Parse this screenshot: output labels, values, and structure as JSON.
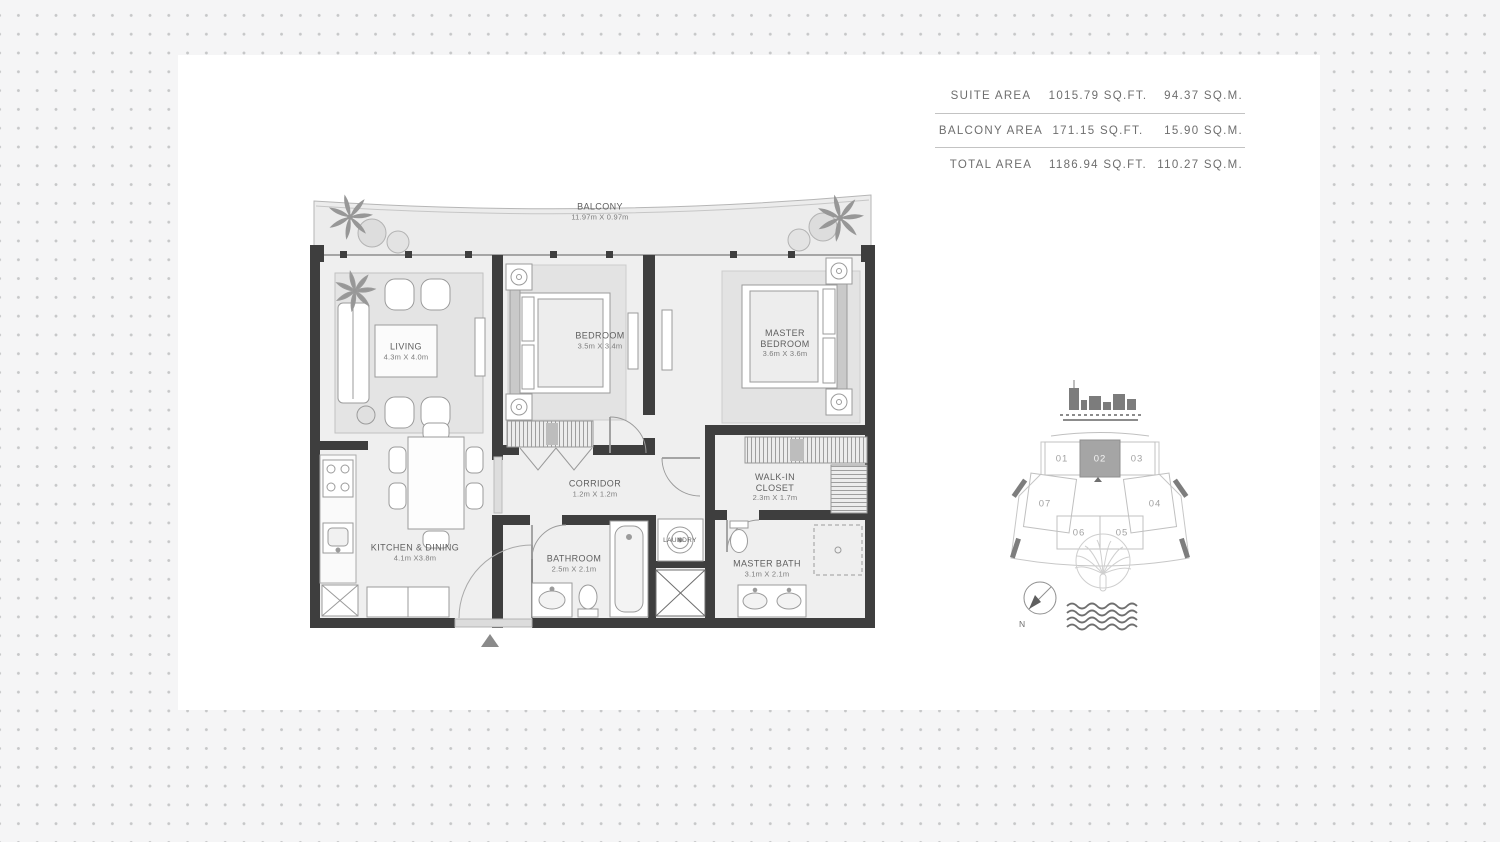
{
  "area_table": {
    "rows": [
      {
        "label": "SUITE AREA",
        "sqft": "1015.79 SQ.FT.",
        "sqm": "94.37 SQ.M."
      },
      {
        "label": "BALCONY AREA",
        "sqft": "171.15 SQ.FT.",
        "sqm": "15.90 SQ.M."
      },
      {
        "label": "TOTAL AREA",
        "sqft": "1186.94 SQ.FT.",
        "sqm": "110.27 SQ.M."
      }
    ]
  },
  "floor_plan": {
    "rooms": {
      "balcony": {
        "name": "BALCONY",
        "dims": "11.97m X 0.97m"
      },
      "living": {
        "name": "LIVING",
        "dims": "4.3m X 4.0m"
      },
      "bedroom": {
        "name": "BEDROOM",
        "dims": "3.5m X 3.4m"
      },
      "master_bedroom": {
        "name": "MASTER BEDROOM",
        "dims": "3.6m X 3.6m"
      },
      "corridor": {
        "name": "CORRIDOR",
        "dims": "1.2m X 1.2m"
      },
      "walk_in_closet": {
        "name": "WALK-IN CLOSET",
        "dims": "2.3m X 1.7m"
      },
      "kitchen_dining": {
        "name": "KITCHEN & DINING",
        "dims": "4.1m X3.8m"
      },
      "bathroom": {
        "name": "BATHROOM",
        "dims": "2.5m X 2.1m"
      },
      "master_bath": {
        "name": "MASTER BATH",
        "dims": "3.1m X 2.1m"
      },
      "laundry": {
        "name": "LAUNDRY",
        "dims": ""
      }
    }
  },
  "key_plan": {
    "units": [
      "01",
      "02",
      "03",
      "04",
      "05",
      "06",
      "07"
    ],
    "highlighted_unit": "02",
    "compass_label": "N"
  },
  "colors": {
    "wall": "#3e3e3e",
    "floor": "#efefef",
    "balcony_floor": "#ececec",
    "highlight_unit_fill": "#a5a5a5",
    "dot": "#c6c7c8"
  }
}
